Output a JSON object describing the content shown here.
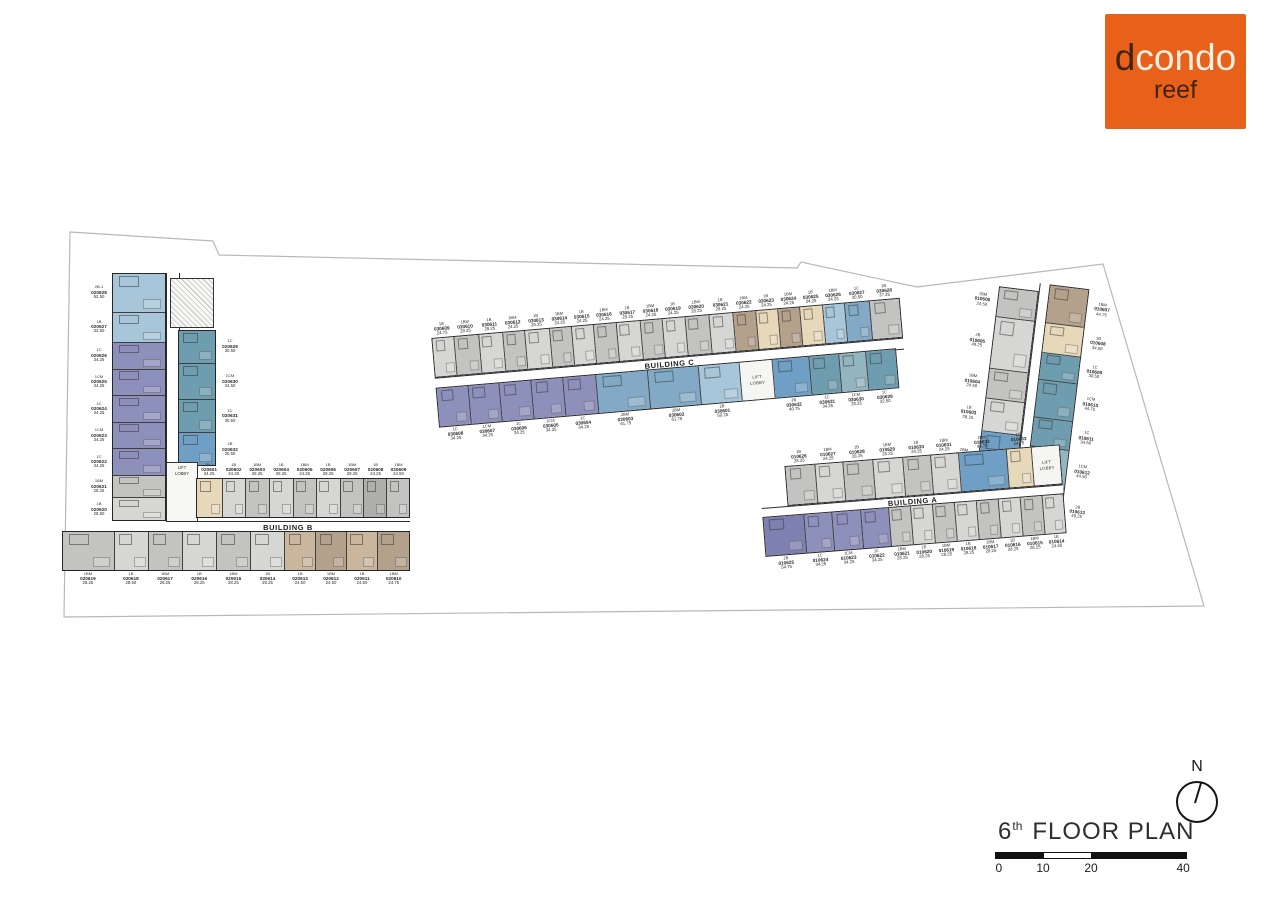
{
  "logo": {
    "d": "d",
    "condo": "condo",
    "reef": "reef",
    "bg_color": "#e8611b",
    "dark_color": "#42230d",
    "light_color": "#f6efe2"
  },
  "title": {
    "number": "6",
    "ordinal": "th",
    "text": "FLOOR PLAN"
  },
  "north_label": "N",
  "scale_bar": {
    "ticks": [
      "0",
      "10",
      "20",
      "40"
    ]
  },
  "lift": {
    "l1": "LIFT",
    "l2": "LOBBY"
  },
  "palette": {
    "g1": "#c3c3c1",
    "g2": "#d6d6d4",
    "g3": "#aeaeac",
    "pu": "#8e90bc",
    "pu2": "#7e80af",
    "bl": "#a7c6da",
    "sb": "#6f9fc4",
    "sb2": "#82aac6",
    "tl": "#6e9daf",
    "tl2": "#93b5bf",
    "tan": "#b4a18b",
    "tan2": "#c9b69c",
    "cr": "#e7d8b9",
    "wh": "#f5f5f3"
  },
  "buildings": {
    "b": {
      "name": "BUILDING B",
      "west_col": [
        {
          "t": "2B-1",
          "no": "020628",
          "a": "52.50",
          "c": "bl",
          "w": 1.5
        },
        {
          "t": "1B",
          "no": "020627",
          "a": "32.50",
          "c": "bl",
          "w": 1.15
        },
        {
          "t": "1C",
          "no": "020626",
          "a": "34.25",
          "c": "pu",
          "w": 1
        },
        {
          "t": "1CM",
          "no": "020625",
          "a": "34.25",
          "c": "pu",
          "w": 1
        },
        {
          "t": "1C",
          "no": "020624",
          "a": "34.25",
          "c": "pu",
          "w": 1
        },
        {
          "t": "1CM",
          "no": "020623",
          "a": "34.25",
          "c": "pu",
          "w": 1
        },
        {
          "t": "1C",
          "no": "020622",
          "a": "34.25",
          "c": "pu",
          "w": 1
        },
        {
          "t": "1BM",
          "no": "020621",
          "a": "28.25",
          "c": "g1",
          "w": 0.85
        },
        {
          "t": "1B",
          "no": "020620",
          "a": "28.50",
          "c": "g2",
          "w": 0.85
        }
      ],
      "mid_col": [
        {
          "t": "1C",
          "no": "020629",
          "a": "30.50",
          "c": "tl",
          "w": 1
        },
        {
          "t": "1CM",
          "no": "020630",
          "a": "34.50",
          "c": "tl",
          "w": 1.1
        },
        {
          "t": "1C",
          "no": "020631",
          "a": "30.50",
          "c": "tl",
          "w": 1
        },
        {
          "t": "2B",
          "no": "020632",
          "a": "30.50",
          "c": "sb",
          "w": 1
        }
      ],
      "top_row": [
        {
          "t": "2B-1",
          "no": "020601",
          "a": "34.25",
          "c": "cr",
          "w": 1.1
        },
        {
          "t": "1B",
          "no": "020602",
          "a": "24.25",
          "c": "g2",
          "w": 0.95
        },
        {
          "t": "1BM",
          "no": "020603",
          "a": "28.25",
          "c": "g1",
          "w": 1
        },
        {
          "t": "1B",
          "no": "020604",
          "a": "28.25",
          "c": "g2",
          "w": 1
        },
        {
          "t": "1BM",
          "no": "020605",
          "a": "24.25",
          "c": "g1",
          "w": 0.95
        },
        {
          "t": "1B",
          "no": "020606",
          "a": "28.25",
          "c": "g2",
          "w": 1
        },
        {
          "t": "1BM",
          "no": "020607",
          "a": "28.25",
          "c": "g1",
          "w": 1
        },
        {
          "t": "1B",
          "no": "020608",
          "a": "24.25",
          "c": "g3",
          "w": 0.95
        },
        {
          "t": "1BM",
          "no": "020609",
          "a": "24.50",
          "c": "g1",
          "w": 0.95
        }
      ],
      "bottom_row": [
        {
          "t": "1BM",
          "no": "020619",
          "a": "28.25",
          "c": "g1",
          "w": 1.55
        },
        {
          "t": "1B",
          "no": "020618",
          "a": "28.50",
          "c": "g2",
          "w": 1
        },
        {
          "t": "1BM",
          "no": "020617",
          "a": "28.25",
          "c": "g1",
          "w": 1
        },
        {
          "t": "1B",
          "no": "020616",
          "a": "28.25",
          "c": "g2",
          "w": 1
        },
        {
          "t": "1BM",
          "no": "020615",
          "a": "28.25",
          "c": "g1",
          "w": 1
        },
        {
          "t": "1B",
          "no": "020614",
          "a": "28.25",
          "c": "g2",
          "w": 1
        },
        {
          "t": "1B",
          "no": "020613",
          "a": "24.50",
          "c": "tan2",
          "w": 0.9
        },
        {
          "t": "1BM",
          "no": "020612",
          "a": "24.50",
          "c": "tan",
          "w": 0.9
        },
        {
          "t": "1B",
          "no": "020611",
          "a": "24.50",
          "c": "tan2",
          "w": 0.9
        },
        {
          "t": "1BM",
          "no": "020610",
          "a": "24.75",
          "c": "tan",
          "w": 0.95
        }
      ]
    },
    "c": {
      "name": "BUILDING C",
      "top_row": [
        {
          "t": "1B",
          "no": "030609",
          "a": "24.75",
          "c": "g2",
          "w": 1
        },
        {
          "t": "1BM",
          "no": "030610",
          "a": "28.25",
          "c": "g1",
          "w": 1.1
        },
        {
          "t": "1B",
          "no": "030611",
          "a": "28.25",
          "c": "g2",
          "w": 1.1
        },
        {
          "t": "1BM",
          "no": "030612",
          "a": "24.25",
          "c": "g1",
          "w": 1
        },
        {
          "t": "1B",
          "no": "030613",
          "a": "28.25",
          "c": "g2",
          "w": 1.1
        },
        {
          "t": "1BM",
          "no": "030614",
          "a": "24.25",
          "c": "g1",
          "w": 1
        },
        {
          "t": "1B",
          "no": "030615",
          "a": "24.25",
          "c": "g2",
          "w": 1
        },
        {
          "t": "1BM",
          "no": "030616",
          "a": "24.25",
          "c": "g1",
          "w": 1
        },
        {
          "t": "1B",
          "no": "030617",
          "a": "28.25",
          "c": "g2",
          "w": 1.1
        },
        {
          "t": "1BM",
          "no": "030618",
          "a": "24.25",
          "c": "g1",
          "w": 1
        },
        {
          "t": "1B",
          "no": "030619",
          "a": "24.25",
          "c": "g2",
          "w": 1
        },
        {
          "t": "1BM",
          "no": "030620",
          "a": "28.25",
          "c": "g1",
          "w": 1.1
        },
        {
          "t": "1B",
          "no": "030621",
          "a": "28.25",
          "c": "g2",
          "w": 1.1
        },
        {
          "t": "1BM",
          "no": "030622",
          "a": "24.25",
          "c": "tan",
          "w": 1
        },
        {
          "t": "1B",
          "no": "030623",
          "a": "24.25",
          "c": "cr",
          "w": 1
        },
        {
          "t": "1BM",
          "no": "030624",
          "a": "24.25",
          "c": "tan",
          "w": 1
        },
        {
          "t": "1B",
          "no": "030625",
          "a": "24.25",
          "c": "cr",
          "w": 1
        },
        {
          "t": "1BM",
          "no": "030626",
          "a": "24.25",
          "c": "bl",
          "w": 1
        },
        {
          "t": "1C",
          "no": "030627",
          "a": "30.50",
          "c": "sb2",
          "w": 1.15
        },
        {
          "t": "2B",
          "no": "030628",
          "a": "37.25",
          "c": "g1",
          "w": 1.35
        }
      ],
      "bottom_row": [
        {
          "t": "1C",
          "no": "030608",
          "a": "34.25",
          "c": "pu",
          "w": 1
        },
        {
          "t": "1CM",
          "no": "030607",
          "a": "34.25",
          "c": "pu",
          "w": 1
        },
        {
          "t": "1C",
          "no": "030606",
          "a": "34.25",
          "c": "pu",
          "w": 1
        },
        {
          "t": "1CM",
          "no": "030605",
          "a": "34.25",
          "c": "pu",
          "w": 1
        },
        {
          "t": "1C",
          "no": "030604",
          "a": "34.25",
          "c": "pu",
          "w": 1.05
        },
        {
          "t": "2BM",
          "no": "030603",
          "a": "61.75",
          "c": "sb2",
          "w": 1.65
        },
        {
          "t": "2BM",
          "no": "030602",
          "a": "61.75",
          "c": "sb2",
          "w": 1.65
        },
        {
          "t": "2B",
          "no": "030601",
          "a": "50.25",
          "c": "bl",
          "w": 1.3
        },
        {
          "lift": true,
          "c": "wh",
          "w": 1.05
        },
        {
          "t": "2B",
          "no": "030632",
          "a": "40.75",
          "c": "sb",
          "w": 1.15
        },
        {
          "t": "1C",
          "no": "030631",
          "a": "34.25",
          "c": "tl",
          "w": 0.95
        },
        {
          "t": "1CM",
          "no": "030630",
          "a": "28.25",
          "c": "tl2",
          "w": 0.85
        },
        {
          "t": "1C",
          "no": "030629",
          "a": "32.50",
          "c": "tl",
          "w": 0.95
        }
      ]
    },
    "a": {
      "name": "BUILDING A",
      "top_row": [
        {
          "t": "1B",
          "no": "010626",
          "a": "28.25",
          "c": "g1",
          "w": 1.1
        },
        {
          "t": "1BM",
          "no": "010627",
          "a": "24.25",
          "c": "g2",
          "w": 1
        },
        {
          "t": "1B",
          "no": "010628",
          "a": "28.25",
          "c": "g1",
          "w": 1.1
        },
        {
          "t": "1BM",
          "no": "010629",
          "a": "28.25",
          "c": "g2",
          "w": 1.1
        },
        {
          "t": "1B",
          "no": "010630",
          "a": "24.25",
          "c": "g1",
          "w": 1
        },
        {
          "t": "1BM",
          "no": "010631",
          "a": "24.25",
          "c": "g2",
          "w": 1
        },
        {
          "t": "2BM",
          "no": "010632",
          "a": "49.75",
          "c": "sb",
          "w": 1.8
        },
        {
          "t": "1B",
          "no": "010633",
          "a": "24.75",
          "c": "cr",
          "w": 0.9
        },
        {
          "lift": true,
          "c": "wh",
          "w": 1
        }
      ],
      "bottom_row": [
        {
          "t": "2B",
          "no": "010625",
          "a": "54.75",
          "c": "pu2",
          "w": 1.9
        },
        {
          "t": "1C",
          "no": "010624",
          "a": "34.25",
          "c": "pu",
          "w": 1.3
        },
        {
          "t": "1CM",
          "no": "010623",
          "a": "34.25",
          "c": "pu",
          "w": 1.3
        },
        {
          "t": "1C",
          "no": "010622",
          "a": "34.25",
          "c": "pu",
          "w": 1.3
        },
        {
          "t": "1BM",
          "no": "010621",
          "a": "28.25",
          "c": "g1",
          "w": 1
        },
        {
          "t": "1B",
          "no": "010620",
          "a": "28.25",
          "c": "g2",
          "w": 1
        },
        {
          "t": "1BM",
          "no": "010619",
          "a": "28.25",
          "c": "g1",
          "w": 1
        },
        {
          "t": "1B",
          "no": "010618",
          "a": "28.25",
          "c": "g2",
          "w": 1
        },
        {
          "t": "1BM",
          "no": "010617",
          "a": "28.25",
          "c": "g1",
          "w": 1
        },
        {
          "t": "1B",
          "no": "010616",
          "a": "28.25",
          "c": "g2",
          "w": 1
        },
        {
          "t": "1BM",
          "no": "010615",
          "a": "28.25",
          "c": "g1",
          "w": 1
        },
        {
          "t": "1B",
          "no": "010614",
          "a": "24.50",
          "c": "g2",
          "w": 0.95
        }
      ],
      "wing_west": [
        {
          "t": "1BM",
          "no": "010606",
          "a": "24.50",
          "c": "g1",
          "w": 1
        },
        {
          "t": "2B",
          "no": "010605",
          "a": "49.25",
          "c": "g2",
          "w": 1.75
        },
        {
          "t": "1BM",
          "no": "010604",
          "a": "24.50",
          "c": "g1",
          "w": 1
        },
        {
          "t": "1B",
          "no": "010603",
          "a": "28.25",
          "c": "g2",
          "w": 1.1
        },
        {
          "t": "2BM",
          "no": "010602",
          "a": "49.75",
          "c": "sb",
          "w": 1.75
        },
        {
          "t": "1BM",
          "no": "010601",
          "a": "24.25",
          "c": "tan",
          "w": 1
        }
      ],
      "wing_east": [
        {
          "t": "1BM",
          "no": "010607",
          "a": "44.75",
          "c": "tan",
          "w": 1.3
        },
        {
          "t": "1B",
          "no": "010608",
          "a": "34.50",
          "c": "cr",
          "w": 1
        },
        {
          "t": "1C",
          "no": "010609",
          "a": "30.50",
          "c": "tl",
          "w": 0.9
        },
        {
          "t": "1CM",
          "no": "010610",
          "a": "44.75",
          "c": "tl",
          "w": 1.3
        },
        {
          "t": "1C",
          "no": "010611",
          "a": "34.50",
          "c": "tl",
          "w": 1
        },
        {
          "t": "1CM",
          "no": "010612",
          "a": "44.50",
          "c": "tl2",
          "w": 1.3
        },
        {
          "t": "2B",
          "no": "010613",
          "a": "49.25",
          "c": "tl",
          "w": 1.45
        }
      ]
    }
  }
}
